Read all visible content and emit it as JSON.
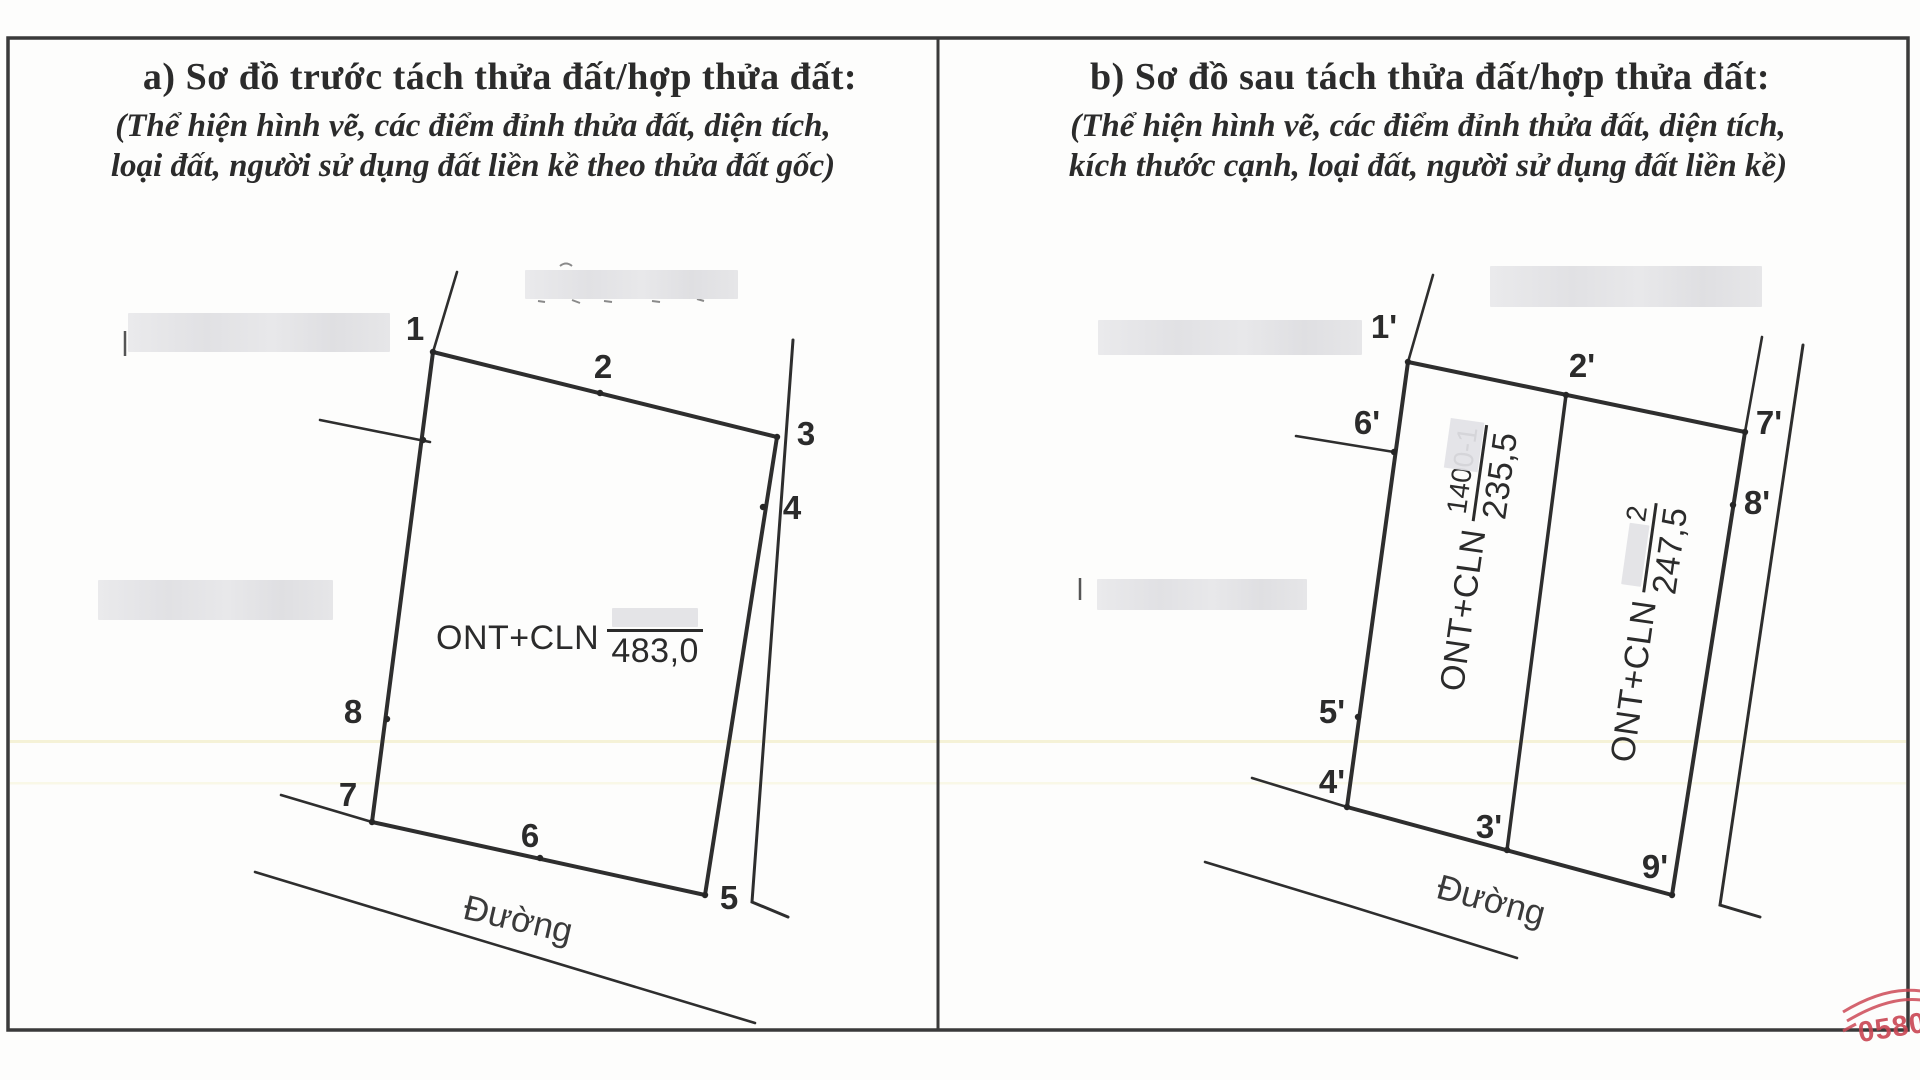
{
  "colors": {
    "ink": "#2b2b2b",
    "line": "#3a3a3a",
    "stamp_red": "#c94653",
    "redaction": "#e4e4e7",
    "streak_yellow": "#eeeab8"
  },
  "panel_a": {
    "title": "a) Sơ đồ trước tách thửa đất/hợp thửa đất:",
    "subtitle_line1": "(Thể hiện hình vẽ, các điểm đỉnh thửa đất, diện tích,",
    "subtitle_line2": "loại đất, người sử dụng đất liền kề theo thửa đất gốc)",
    "parcel": {
      "land_use": "ONT+CLN",
      "area": "483,0"
    },
    "road_label": "Đường",
    "vertices": [
      {
        "label": "1",
        "x": 433,
        "y": 352,
        "lx": 415,
        "ly": 329
      },
      {
        "label": "2",
        "x": 600,
        "y": 393,
        "lx": 603,
        "ly": 367
      },
      {
        "label": "3",
        "x": 777,
        "y": 437,
        "lx": 806,
        "ly": 434
      },
      {
        "label": "4",
        "x": 763,
        "y": 507,
        "lx": 792,
        "ly": 508
      },
      {
        "label": "5",
        "x": 705,
        "y": 895,
        "lx": 729,
        "ly": 898
      },
      {
        "label": "6",
        "x": 540,
        "y": 858,
        "lx": 530,
        "ly": 836
      },
      {
        "label": "7",
        "x": 372,
        "y": 822,
        "lx": 348,
        "ly": 795
      },
      {
        "label": "8",
        "x": 387,
        "y": 719,
        "lx": 353,
        "ly": 712
      },
      {
        "label": "",
        "x": 423,
        "y": 440,
        "lx": 0,
        "ly": 0
      }
    ]
  },
  "panel_b": {
    "title": "b) Sơ đồ sau tách thửa đất/hợp thửa đất:",
    "subtitle_line1": "(Thể hiện hình vẽ, các điểm đỉnh thửa đất, diện tích,",
    "subtitle_line2": "kích thước cạnh, loại đất, người sử dụng đất liền kề)",
    "parcel_1": {
      "land_use": "ONT+CLN",
      "parcel_number": "1400-1",
      "area": "235,5"
    },
    "parcel_2": {
      "land_use": "ONT+CLN",
      "parcel_number_visible": "2",
      "area": "247,5"
    },
    "road_label": "Đường",
    "vertices": [
      {
        "label": "1'",
        "x": 1408,
        "y": 362,
        "lx": 1384,
        "ly": 327
      },
      {
        "label": "2'",
        "x": 1566,
        "y": 395,
        "lx": 1582,
        "ly": 366
      },
      {
        "label": "7'",
        "x": 1745,
        "y": 432,
        "lx": 1769,
        "ly": 423
      },
      {
        "label": "8'",
        "x": 1733,
        "y": 505,
        "lx": 1757,
        "ly": 503
      },
      {
        "label": "9'",
        "x": 1672,
        "y": 895,
        "lx": 1655,
        "ly": 867
      },
      {
        "label": "3'",
        "x": 1507,
        "y": 850,
        "lx": 1489,
        "ly": 827
      },
      {
        "label": "4'",
        "x": 1347,
        "y": 807,
        "lx": 1332,
        "ly": 782
      },
      {
        "label": "5'",
        "x": 1358,
        "y": 717,
        "lx": 1332,
        "ly": 712
      },
      {
        "label": "6'",
        "x": 1394,
        "y": 452,
        "lx": 1367,
        "ly": 423
      }
    ]
  },
  "stamp": {
    "visible_digits": "0580"
  }
}
